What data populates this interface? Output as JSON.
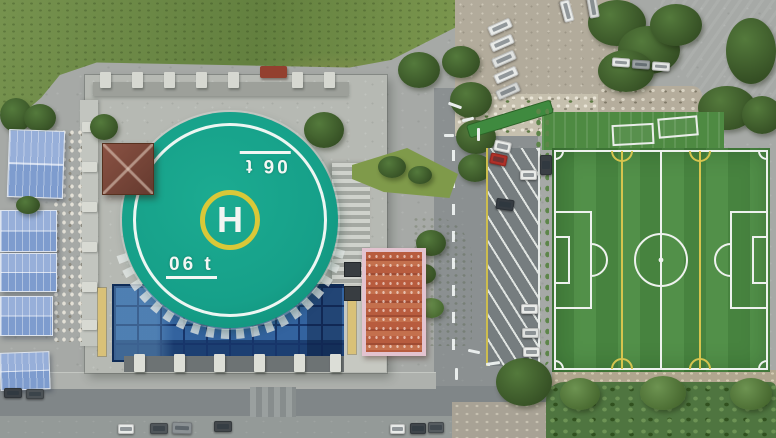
{
  "scene": {
    "type": "aerial-drone-photograph",
    "description": "Top-down aerial view: a teal rooftop helipad with a yellow ring and white H on a castle-style building with a blue glass atrium roof; an artificial-turf soccer field to the east; an angled parking lane with cars between them; blue metal warehouse roofs to the west; wild grass field to the north-west; a gravel lot, trees and a dark-red roofed building to the north-east; roads with white markings and parked cars along the bottom."
  },
  "helipad": {
    "letter": "H",
    "weight_marking_top": "06 t",
    "weight_marking_bottom": "06 t"
  },
  "colors": {
    "helipad_teal": "#16a089",
    "helipad_ring_yellow": "#d9c838",
    "line_white": "#f2f6f3",
    "rooftop_gray": "#b6b9b3",
    "glass_blue": "#2d5da0",
    "warehouse_roof_blue": "#8ba6d6",
    "turf_green": "#47833f",
    "turf_line_yellow": "#d6c44e",
    "asphalt_gray": "#8d9293",
    "grass_green": "#75914d",
    "tree_green": "#3d5c33",
    "dirt_tan": "#b3ab9b",
    "maroon_roof": "#6e3d39",
    "pink_border": "#e3c3cf",
    "tile_orange": "#b55a3c",
    "car_red": "#b03028"
  }
}
